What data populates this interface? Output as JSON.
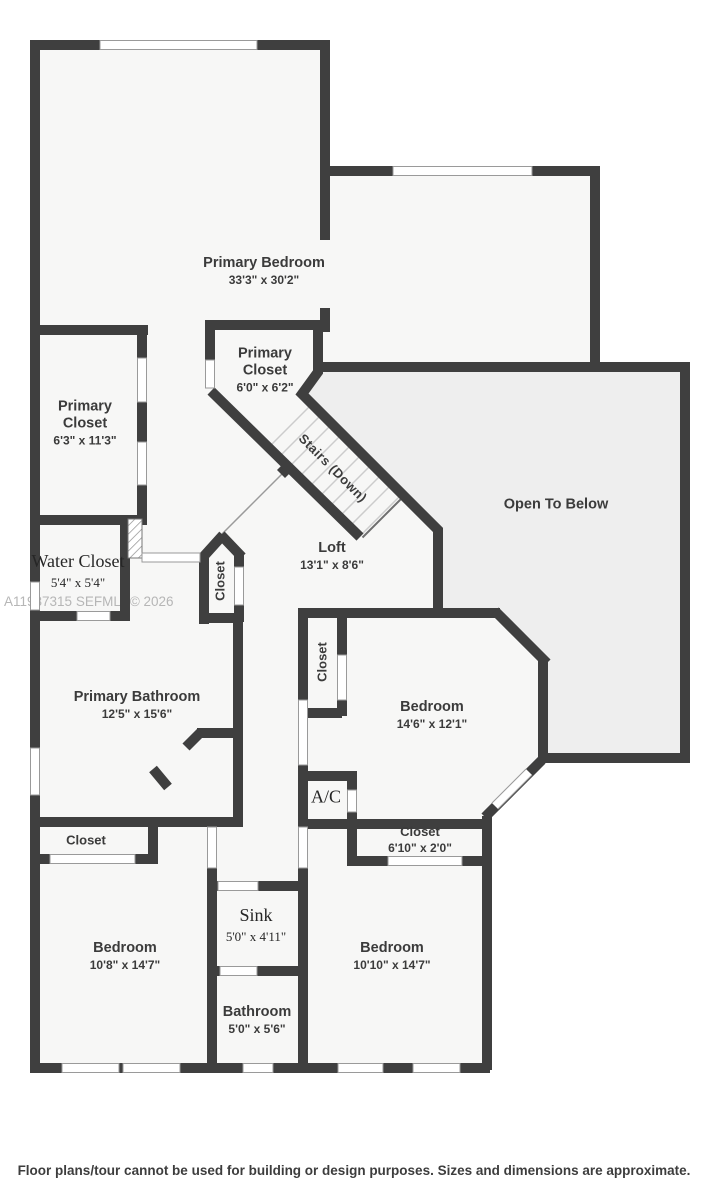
{
  "watermark": "A11987315  SEFMLS© 2026",
  "footer": "Floor plans/tour cannot be used for building or design purposes. Sizes and dimensions are approximate.",
  "colors": {
    "wall": "#3f3f3f",
    "room_fill": "#f7f7f6",
    "open_area_fill": "#eeeeee",
    "window_outline": "#9a9a9a",
    "tread_line": "#cccccc",
    "label_text": "#3b3b3b",
    "watermark_text": "#b6b6b6"
  },
  "rooms": {
    "primary_bedroom": {
      "name": "Primary Bedroom",
      "dims": "33'3\" x 30'2\""
    },
    "primary_closet_left": {
      "name": "Primary Closet",
      "dims": "6'3\" x 11'3\""
    },
    "primary_closet_small": {
      "name": "Primary Closet",
      "dims": "6'0\" x 6'2\""
    },
    "water_closet": {
      "name": "Water Closet",
      "dims": "5'4\" x 5'4\""
    },
    "loft": {
      "name": "Loft",
      "dims": "13'1\" x 8'6\""
    },
    "open_below": {
      "name": "Open To Below"
    },
    "stairs": {
      "name": "Stairs (Down)"
    },
    "closet_hall": {
      "name": "Closet"
    },
    "primary_bathroom": {
      "name": "Primary Bathroom",
      "dims": "12'5\" x 15'6\""
    },
    "bedroom_mid": {
      "name": "Bedroom",
      "dims": "14'6\" x 12'1\""
    },
    "closet_bedroom_mid": {
      "name": "Closet"
    },
    "ac": {
      "name": "A/C"
    },
    "closet_strip": {
      "name": "Closet"
    },
    "closet_long": {
      "name": "Closet",
      "dims": "6'10\" x 2'0\""
    },
    "bedroom_bottom_left": {
      "name": "Bedroom",
      "dims": "10'8\" x 14'7\""
    },
    "sink": {
      "name": "Sink",
      "dims": "5'0\" x 4'11\""
    },
    "bedroom_bottom_right": {
      "name": "Bedroom",
      "dims": "10'10\" x 14'7\""
    },
    "bathroom": {
      "name": "Bathroom",
      "dims": "5'0\" x 5'6\""
    }
  }
}
